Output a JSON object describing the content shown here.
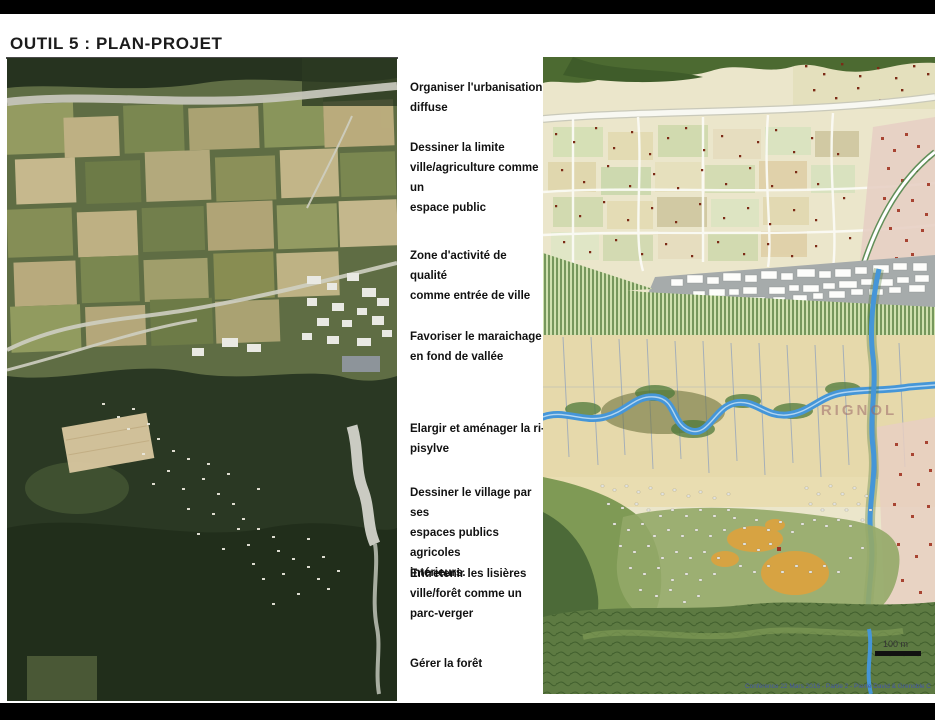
{
  "slide": {
    "title": "OUTIL 5 : PLAN-PROJET"
  },
  "annotations": {
    "items": [
      "Organiser l'urbanisation\ndiffuse",
      "Dessiner la limite\nville/agriculture comme un\nespace public",
      "Zone d'activité de qualité\ncomme entrée de ville",
      "Favoriser le maraichage\nen fond de vallée",
      "Elargir et aménager la ri-\npisylve",
      "Dessiner le village par ses\nespaces publics agricoles\nintérieurs.",
      "Entretenir les lisières\nville/forêt comme un\nparc-verger",
      "Gérer la forêt"
    ]
  },
  "map": {
    "scale_label": "100 m",
    "background_label": "RIGNOL",
    "attribution": "Conférence 22 Mars 2016 - Partie 2 - Pierre David & Grenoble C"
  },
  "colors": {
    "frame_bg": "#000000",
    "slide_bg": "#ffffff",
    "river_blue": "#4596d8",
    "valley_cream": "#e6d9ab",
    "forest_green": "#47662e",
    "orange_highlight": "#e2a23a",
    "activity_gray": "#a6abab",
    "house_dot_red": "#7c2b16"
  }
}
